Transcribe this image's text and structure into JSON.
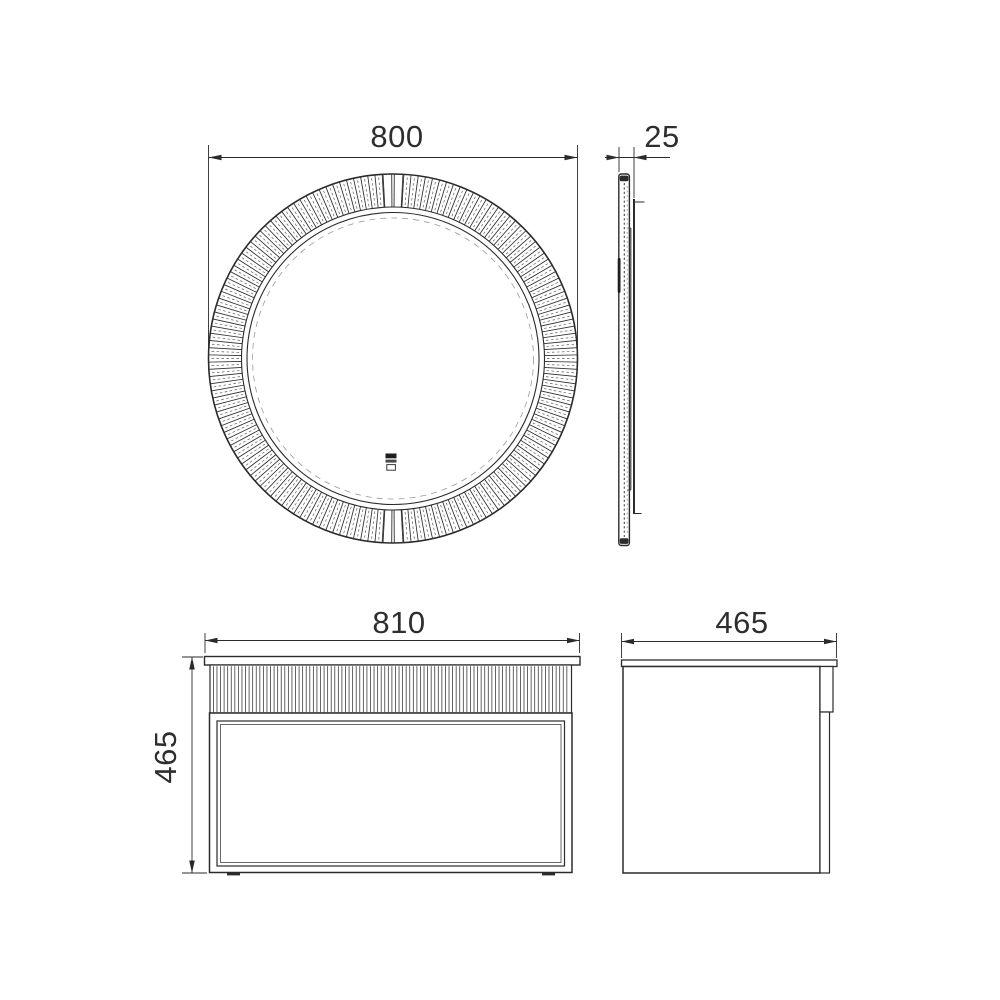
{
  "colors": {
    "line": "#2b2b2b",
    "text": "#2e2e2e",
    "background": "#ffffff",
    "detail": "#555555"
  },
  "dimensions": {
    "mirror_width": "800",
    "mirror_depth": "25",
    "vanity_width": "810",
    "vanity_height": "465",
    "vanity_depth": "465"
  },
  "icons": [
    {
      "name": "touch-switch-icon"
    }
  ]
}
